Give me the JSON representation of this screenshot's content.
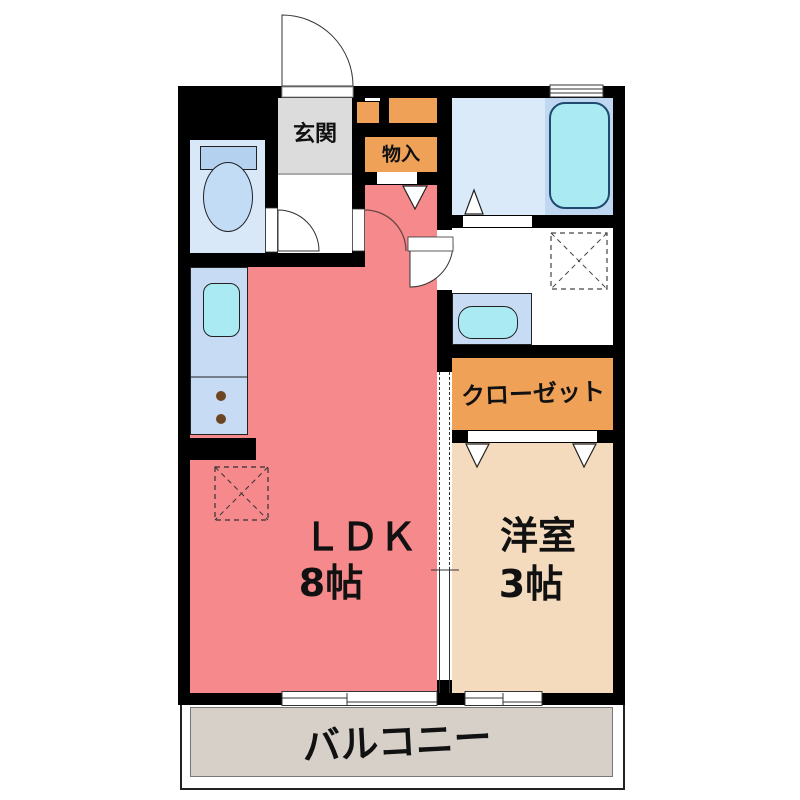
{
  "rooms": {
    "genkan": {
      "label": "玄関"
    },
    "storage": {
      "label": "物入"
    },
    "closet": {
      "label": "クローゼット"
    },
    "ldk": {
      "label": "ＬＤＫ",
      "size": "8帖"
    },
    "western": {
      "label": "洋室",
      "size": "3帖"
    },
    "balcony": {
      "label": "バルコニー"
    }
  },
  "colors": {
    "wall": "#000000",
    "ldk_floor": "#f5898b",
    "western_floor": "#f5dbbd",
    "storage_orange": "#efa257",
    "genkan_gray": "#dcdcdc",
    "counter_blue": "#c7dcf4",
    "fixture_cyan": "#a9eaf3",
    "toilet_floor": "#d8e8f9",
    "toilet_tank": "#b4d2ef",
    "toilet_bowl": "#c3dcf6",
    "bath_floor": "#dbeaf9",
    "bathtub_zone": "#c0d7f1",
    "balcony_floor": "#d6d0c8",
    "burner_brown": "#6e4523"
  }
}
